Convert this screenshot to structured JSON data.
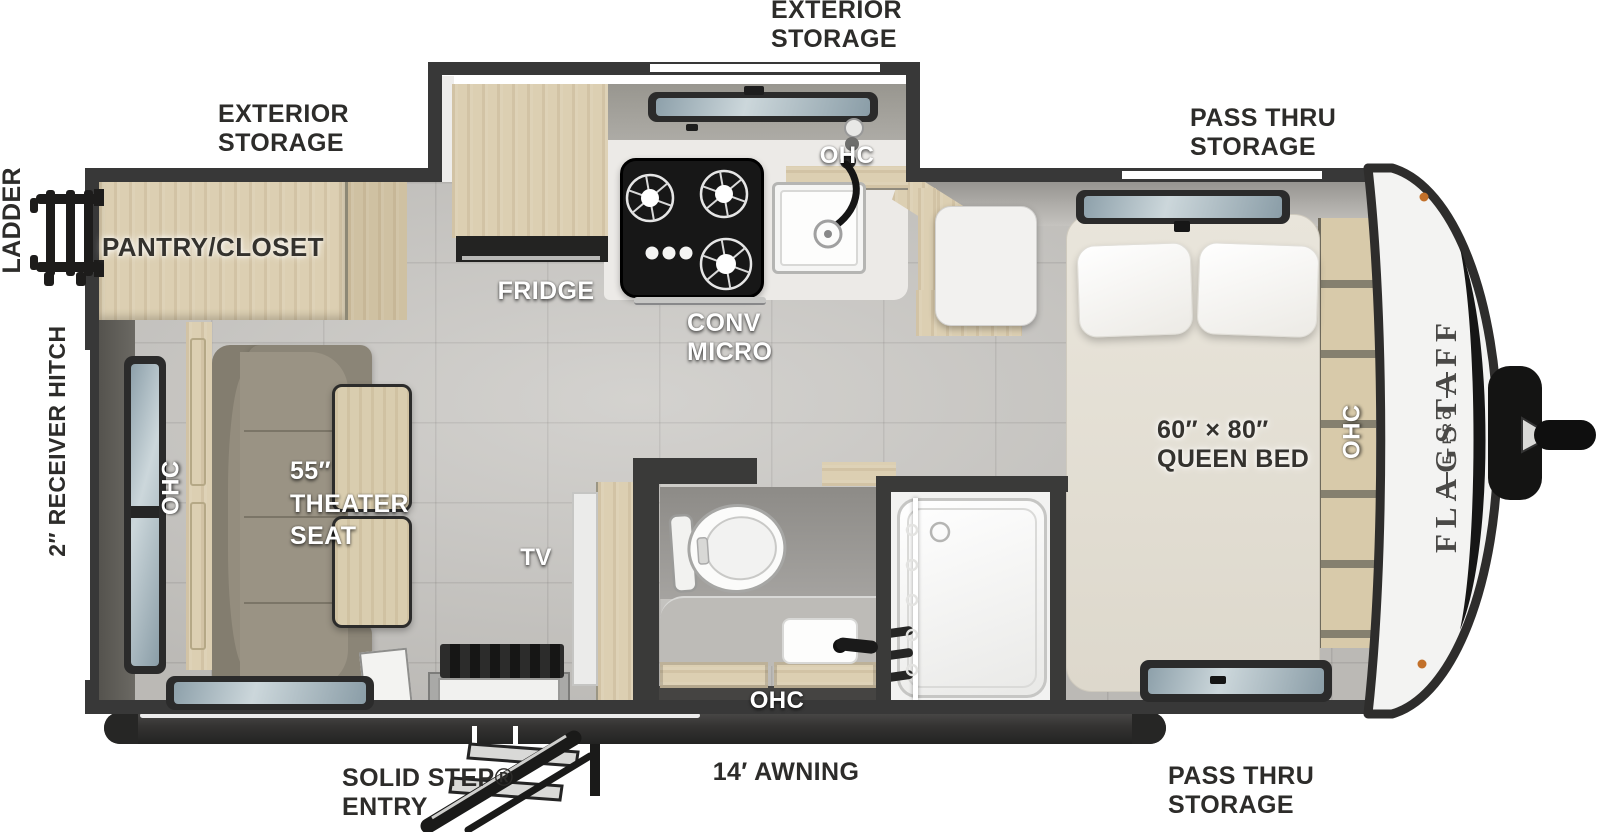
{
  "title": "Flagstaff E-Pro travel trailer floor plan",
  "colors": {
    "wall": "#383838",
    "floor": "#c9c7c3",
    "wood": "#dccfb2",
    "theater_seat": "#9a9384",
    "mattress": "#e6e2d8",
    "marker_light": "#c2702a",
    "label_dark": "#2d2c2a",
    "label_white": "#ffffff"
  },
  "brand": {
    "name": "FLAGSTAFF",
    "sub": "E-PRO"
  },
  "exterior_labels": {
    "storage_top": {
      "l1": "EXTERIOR",
      "l2": "STORAGE"
    },
    "storage_rear": {
      "l1": "EXTERIOR",
      "l2": "STORAGE"
    },
    "pass_thru_top": {
      "l1": "PASS THRU",
      "l2": "STORAGE"
    },
    "pass_thru_bottom": {
      "l1": "PASS THRU",
      "l2": "STORAGE"
    },
    "ladder": "LADDER",
    "receiver_hitch": "2″ RECEIVER HITCH",
    "solid_step": {
      "l1": "SOLID STEP®",
      "l2": "ENTRY"
    },
    "awning": "14′ AWNING"
  },
  "interior_labels": {
    "pantry": "PANTRY/CLOSET",
    "fridge": "FRIDGE",
    "conv_micro": {
      "l1": "CONV",
      "l2": "MICRO"
    },
    "ohc_kitchen": "OHC",
    "ohc_bed": "OHC",
    "ohc_theater": "OHC",
    "ohc_bath": "OHC",
    "queen_bed": {
      "l1": "60″ × 80″",
      "l2": "QUEEN BED"
    },
    "theater_seat": {
      "l1": "55″",
      "l2": "THEATER",
      "l3": "SEAT"
    },
    "tv": "TV"
  }
}
